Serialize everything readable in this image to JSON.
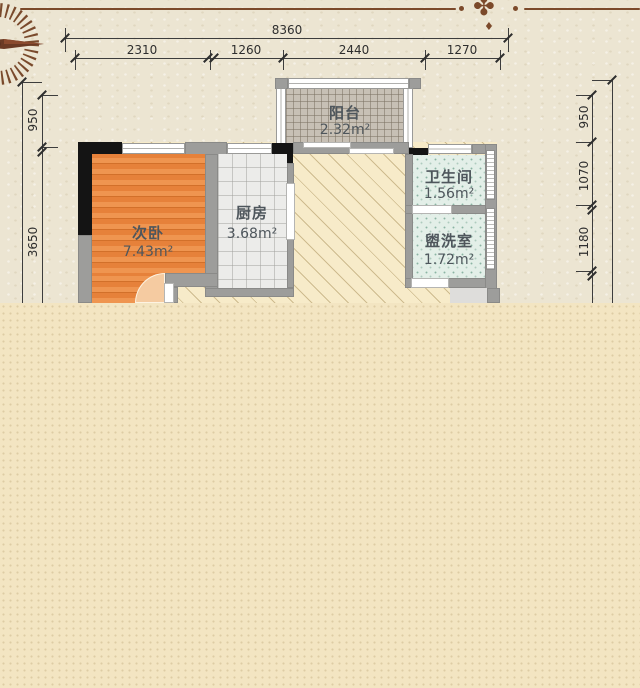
{
  "rooms": {
    "balcony": {
      "name": "阳台",
      "area": "2.32m²"
    },
    "bedroom": {
      "name": "次卧",
      "area": "7.43m²"
    },
    "kitchen": {
      "name": "厨房",
      "area": "3.68m²"
    },
    "bathroom": {
      "name": "卫生间",
      "area": "1.56m²"
    },
    "washroom": {
      "name": "盥洗室",
      "area": "1.72m²"
    }
  },
  "dimensions": {
    "top_total": "8360",
    "top_segments": [
      "2310",
      "1260",
      "2440",
      "1270"
    ],
    "left_segments": [
      "950",
      "3650"
    ],
    "right_segments": [
      "950",
      "1070",
      "1180"
    ]
  },
  "icons": {
    "compass": "compass-rose-icon",
    "ornament_glyph": "✤",
    "ornament_pendant": "♦"
  },
  "colors": {
    "accent_brown": "#7c4a2b",
    "wall_gray": "#9d9d9b",
    "column_black": "#141414",
    "bedroom_floor": "#e6813a",
    "kitchen_floor": "#ececea",
    "bath_floor": "#e3efe8",
    "balcony_floor": "#c7c0b5",
    "living_floor": "#f7ebc9",
    "paper_bg": "#ece5d2",
    "bottom_bg": "#f3e5c2",
    "dim_text": "#2e2e2e",
    "label_text": "#4e565c"
  }
}
